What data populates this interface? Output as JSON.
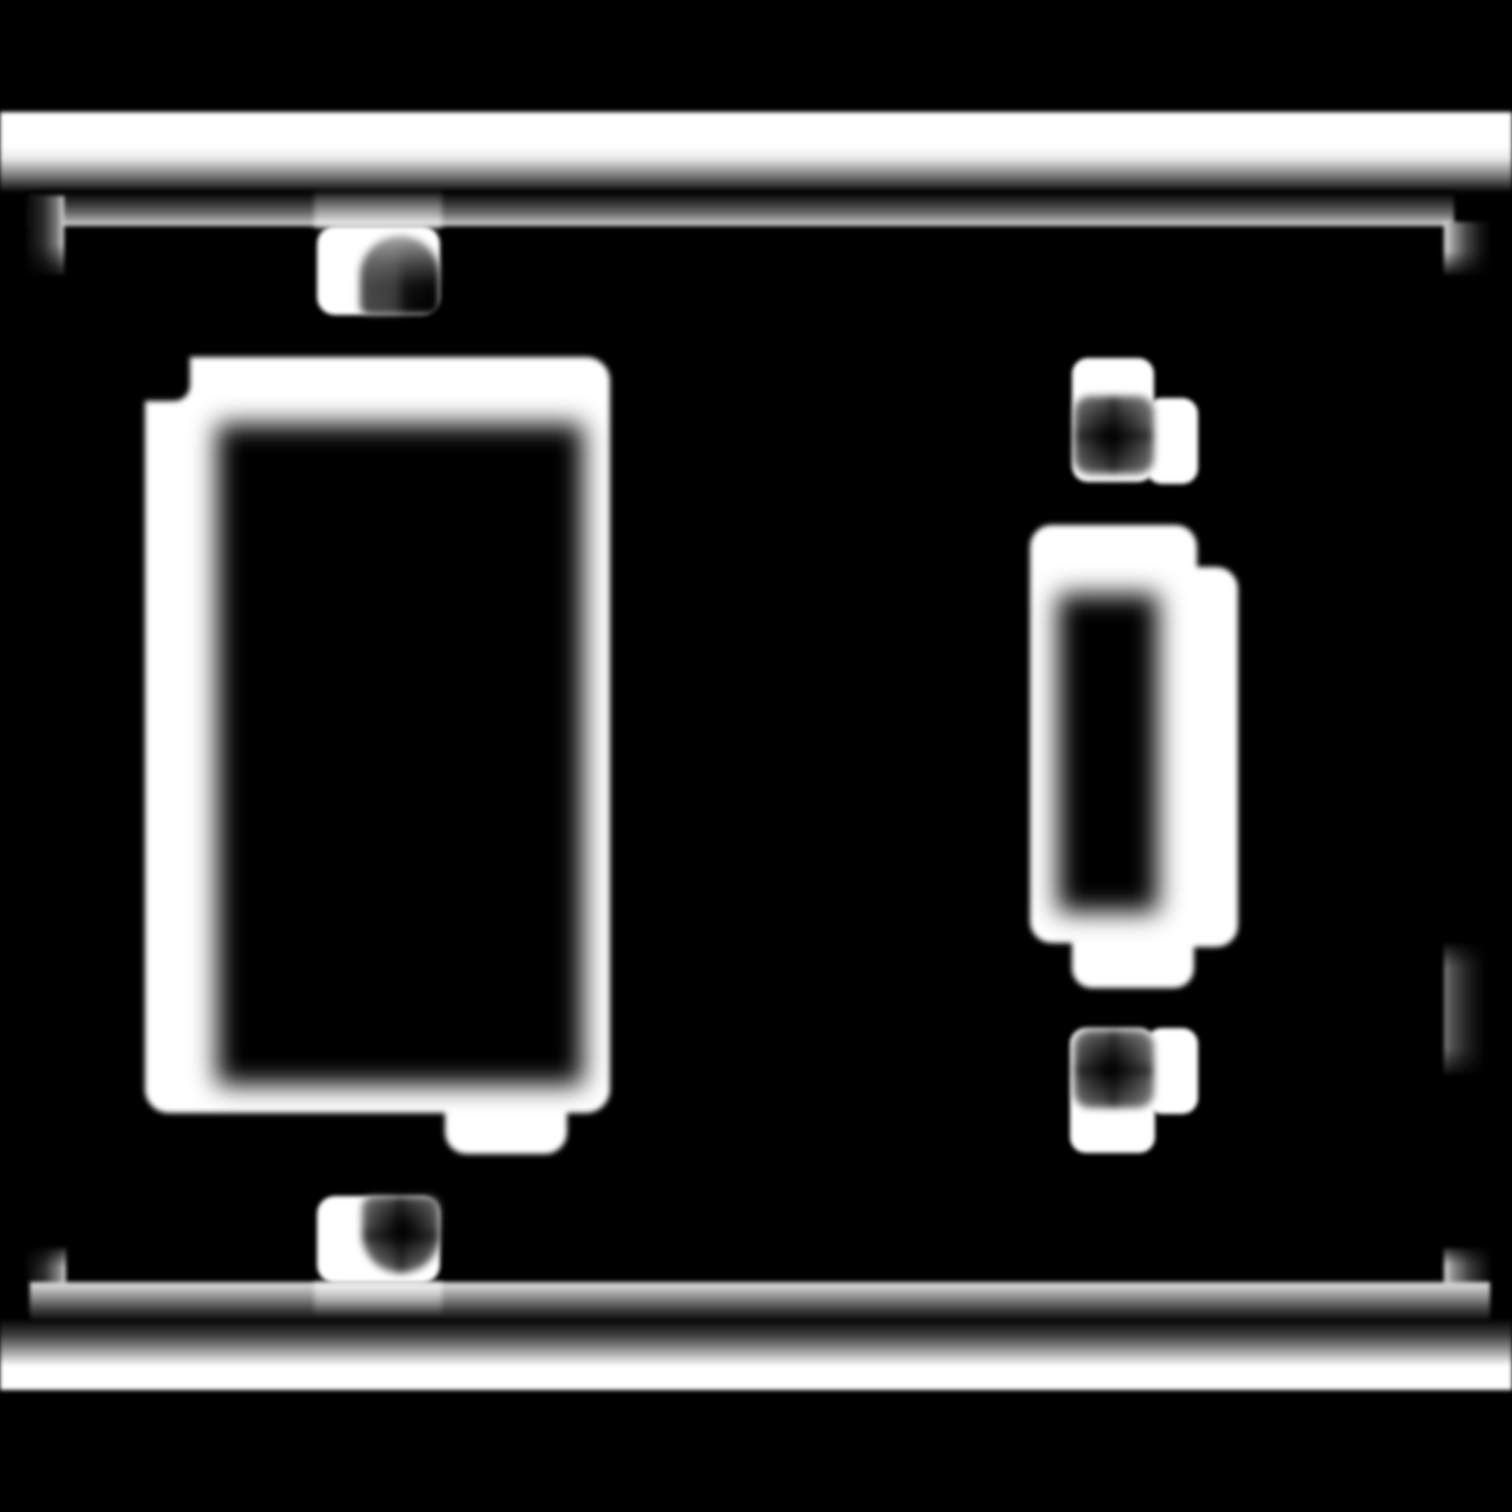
{
  "meta": {
    "title": "Blurred monochrome drawing of a two-gang switch wall plate",
    "subject": "two-gang-wall-plate",
    "style": "white blurred line art on black background",
    "has_text": false
  },
  "canvas": {
    "width": 1512,
    "height": 1512,
    "background": "#000000",
    "ink": "#ffffff"
  },
  "figure": {
    "name": "wall-plate-figure",
    "shapes": [
      {
        "name": "top-plate-band",
        "x": 0,
        "y": 112,
        "w": 1512,
        "h": 80,
        "z": 1,
        "blur": 2,
        "bg": "linear-gradient(180deg, #ffffff 0%, #ffffff 42%, #e9e9e9 58%, #6f6f6f 82%, #050505 100%)"
      },
      {
        "name": "frame-top-edge",
        "x": 30,
        "y": 192,
        "w": 1424,
        "h": 34,
        "z": 1,
        "blur": 2,
        "bg": "linear-gradient(180deg, #000000 0%, #2e2e2e 30%, #6a6a6a 62%, #aaaaaa 86%, #d6d6d6 97%, #bdbdbd 100%)"
      },
      {
        "name": "frame-top-edge-highlight",
        "x": 314,
        "y": 192,
        "w": 128,
        "h": 36,
        "z": 2,
        "blur": 3,
        "bg": "linear-gradient(180deg, rgba(255,255,255,0.10) 0%, rgba(255,255,255,0.45) 70%, rgba(255,255,255,0.65) 100%)"
      },
      {
        "name": "frame-corner-top-left",
        "x": 26,
        "y": 196,
        "w": 38,
        "h": 78,
        "z": 1,
        "blur": 2,
        "bg": "linear-gradient(180deg, rgba(0,0,0,0) 62%, rgba(0,0,0,0.78) 94%), linear-gradient(90deg, #050505 0%, #2b2b2b 45%, #7d7d7d 82%, #cfcfcf 97%, #e6e6e6 100%)"
      },
      {
        "name": "frame-corner-top-right",
        "x": 1444,
        "y": 222,
        "w": 48,
        "h": 52,
        "z": 1,
        "blur": 2,
        "bg": "linear-gradient(180deg, rgba(0,0,0,0) 55%, rgba(0,0,0,0.8) 95%), linear-gradient(90deg, #e2e2e2 0%, #9a9a9a 18%, #4a4a4a 45%, #111111 78%, #000000 100%)"
      },
      {
        "name": "frame-right-segment",
        "x": 1444,
        "y": 944,
        "w": 42,
        "h": 130,
        "z": 1,
        "blur": 2,
        "op": 0.9,
        "bg": "linear-gradient(180deg, rgba(0,0,0,0.85) 0%, rgba(0,0,0,0) 18%, rgba(0,0,0,0) 80%, rgba(0,0,0,0.85) 100%), linear-gradient(90deg, #8a8a8a 0%, #5a5a5a 18%, #262626 55%, #000000 100%)"
      },
      {
        "name": "frame-corner-bottom-left",
        "x": 26,
        "y": 1248,
        "w": 40,
        "h": 64,
        "z": 1,
        "blur": 2,
        "bg": "linear-gradient(180deg, rgba(0,0,0,0.8) 0%, rgba(0,0,0,0) 30%), linear-gradient(90deg, #050505 0%, #2b2b2b 45%, #8a8a8a 84%, #dadada 100%)"
      },
      {
        "name": "frame-corner-bottom-right",
        "x": 1444,
        "y": 1248,
        "w": 48,
        "h": 56,
        "z": 1,
        "blur": 2,
        "bg": "linear-gradient(180deg, rgba(0,0,0,0.8) 0%, rgba(0,0,0,0) 30%), linear-gradient(90deg, #dadada 0%, #8a8a8a 20%, #3a3a3a 55%, #000000 100%)"
      },
      {
        "name": "frame-bottom-edge",
        "x": 30,
        "y": 1282,
        "w": 1460,
        "h": 42,
        "z": 1,
        "blur": 2,
        "bg": "linear-gradient(180deg, #c9c9c9 0%, #d6d6d6 8%, #8a8a8a 38%, #3a3a3a 68%, #000000 100%)"
      },
      {
        "name": "frame-bottom-edge-highlight",
        "x": 314,
        "y": 1282,
        "w": 128,
        "h": 32,
        "z": 2,
        "blur": 3,
        "bg": "linear-gradient(180deg, rgba(255,255,255,0.65) 0%, rgba(255,255,255,0.35) 55%, rgba(255,255,255,0.05) 100%)"
      },
      {
        "name": "bottom-plate-band",
        "x": 0,
        "y": 1320,
        "w": 1512,
        "h": 70,
        "z": 1,
        "blur": 2,
        "bg": "linear-gradient(180deg, #070707 0%, #3f3f3f 22%, #9a9a9a 44%, #ffffff 66%, #ffffff 100%)"
      },
      {
        "name": "rocker-frame",
        "x": 145,
        "y": 357,
        "w": 465,
        "h": 756,
        "z": 3,
        "blur": 3,
        "bg": "#ffffff",
        "r": "24px"
      },
      {
        "name": "rocker-frame-step",
        "x": 132,
        "y": 344,
        "w": 58,
        "h": 57,
        "z": 4,
        "blur": 3,
        "bg": "#000000",
        "r": "0 0 16px 0"
      },
      {
        "name": "rocker-opening",
        "x": 217,
        "y": 424,
        "w": 366,
        "h": 661,
        "z": 5,
        "blur": 13,
        "bg": "#000000"
      },
      {
        "name": "rocker-screw-tab-top",
        "x": 317,
        "y": 226,
        "w": 123,
        "h": 89,
        "z": 6,
        "blur": 2,
        "bg": "#ffffff",
        "r": "18px"
      },
      {
        "name": "rocker-screw-top",
        "x": 360,
        "y": 236,
        "w": 80,
        "h": 79,
        "z": 7,
        "blur": 4,
        "bg": "linear-gradient(180deg, rgba(173,173,173,0.95) 0%, rgba(120,120,120,0.55) 35%, rgba(60,60,60,0.12) 62%, rgba(0,0,0,0) 80%), linear-gradient(90deg, #4c4c4c 0%, #3c3c3c 44%, #0c0c0c 58%, #000000 100%)",
        "r": "40px 40px 10px 10px"
      },
      {
        "name": "rocker-bottom-tab",
        "x": 445,
        "y": 1094,
        "w": 122,
        "h": 60,
        "z": 4,
        "blur": 3,
        "bg": "#ffffff",
        "r": "0 0 22px 22px"
      },
      {
        "name": "rocker-screw-tab-bottom",
        "x": 317,
        "y": 1196,
        "w": 123,
        "h": 87,
        "z": 6,
        "blur": 2,
        "bg": "#ffffff",
        "r": "18px"
      },
      {
        "name": "rocker-screw-bottom",
        "x": 362,
        "y": 1196,
        "w": 78,
        "h": 77,
        "z": 7,
        "blur": 4,
        "bg": "linear-gradient(90deg, rgba(0,0,0,0) 40%, rgba(0,0,0,0.5) 49%, rgba(0,0,0,0) 60%), linear-gradient(180deg, rgba(0,0,0,0) 40%, rgba(0,0,0,0.5) 52%, rgba(0,0,0,0) 64%), radial-gradient(circle at 52% 44%, #000000 0%, #0a0a0a 12%, #3c3c3c 48%, #7d7d7d 84%, #9b9b9b 100%)",
        "r": "12px 12px 40px 40px"
      },
      {
        "name": "toggle-frame",
        "x": 1030,
        "y": 525,
        "w": 167,
        "h": 418,
        "z": 3,
        "blur": 3,
        "bg": "#ffffff",
        "r": "22px"
      },
      {
        "name": "toggle-frame-offset",
        "x": 1148,
        "y": 567,
        "w": 90,
        "h": 380,
        "z": 3,
        "blur": 3,
        "bg": "#ffffff",
        "r": "22px"
      },
      {
        "name": "toggle-bottom-tab",
        "x": 1072,
        "y": 936,
        "w": 122,
        "h": 52,
        "z": 4,
        "blur": 3,
        "bg": "#ffffff",
        "r": "0 0 20px 20px"
      },
      {
        "name": "toggle-opening",
        "x": 1058,
        "y": 594,
        "w": 100,
        "h": 318,
        "z": 5,
        "blur": 13,
        "bg": "#000000"
      },
      {
        "name": "toggle-screw-tab-top",
        "x": 1072,
        "y": 358,
        "w": 82,
        "h": 124,
        "z": 6,
        "blur": 2,
        "bg": "#ffffff",
        "r": "16px"
      },
      {
        "name": "toggle-screw-tab-top-ext",
        "x": 1146,
        "y": 398,
        "w": 52,
        "h": 86,
        "z": 6,
        "blur": 2,
        "bg": "#ffffff",
        "r": "16px"
      },
      {
        "name": "toggle-screw-top",
        "x": 1074,
        "y": 396,
        "w": 80,
        "h": 78,
        "z": 7,
        "blur": 4,
        "bg": "linear-gradient(90deg, rgba(0,0,0,0) 40%, rgba(0,0,0,0.45) 49%, rgba(0,0,0,0) 59%), linear-gradient(180deg, rgba(0,0,0,0) 40%, rgba(0,0,0,0.45) 51%, rgba(0,0,0,0) 62%), radial-gradient(circle at 47% 53%, #000000 0%, #0a0a0a 10%, #373737 45%, #747474 82%, #9e9e9e 100%)",
        "r": "16px"
      },
      {
        "name": "toggle-screw-tab-bottom",
        "x": 1070,
        "y": 1028,
        "w": 85,
        "h": 125,
        "z": 6,
        "blur": 2,
        "bg": "#ffffff",
        "r": "16px"
      },
      {
        "name": "toggle-screw-tab-bottom-ext",
        "x": 1146,
        "y": 1028,
        "w": 52,
        "h": 86,
        "z": 6,
        "blur": 2,
        "bg": "#ffffff",
        "r": "16px"
      },
      {
        "name": "toggle-screw-bottom",
        "x": 1074,
        "y": 1030,
        "w": 80,
        "h": 78,
        "z": 7,
        "blur": 4,
        "bg": "linear-gradient(90deg, rgba(0,0,0,0) 40%, rgba(0,0,0,0.45) 49%, rgba(0,0,0,0) 59%), linear-gradient(180deg, rgba(0,0,0,0) 40%, rgba(0,0,0,0.45) 52%, rgba(0,0,0,0) 64%), radial-gradient(circle at 46% 50%, #000000 0%, #0a0a0a 10%, #373737 45%, #747474 82%, #9e9e9e 100%)",
        "r": "16px"
      }
    ]
  }
}
